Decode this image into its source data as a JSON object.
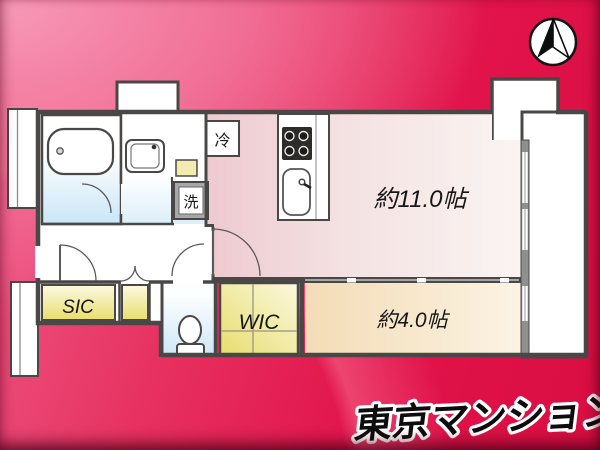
{
  "plan": {
    "rooms": {
      "ldk": {
        "label": "約11.0帖"
      },
      "bedroom": {
        "label": "約4.0帖"
      },
      "sic": {
        "label": "SIC"
      },
      "wic": {
        "label": "WIC"
      }
    },
    "fixtures": {
      "refrigerator": {
        "label": "冷"
      },
      "washer": {
        "label": "洗"
      }
    }
  },
  "branding": {
    "logo_text": "東京マンション"
  },
  "icons": {
    "compass": "north-arrow-compass-icon"
  },
  "colors": {
    "background_pink": "#f17097",
    "background_crimson": "#e1134a",
    "wall": "#4a4846",
    "room_ldk_pink": "#eec9d0",
    "room_bedroom_cream": "#f3dcb6",
    "closet_yellow": "#e9df72",
    "wet_area_blue": "#cde7f6",
    "balcony_white": "#ffffff",
    "logo_fill": "#111111",
    "logo_outline": "#ffffff"
  }
}
